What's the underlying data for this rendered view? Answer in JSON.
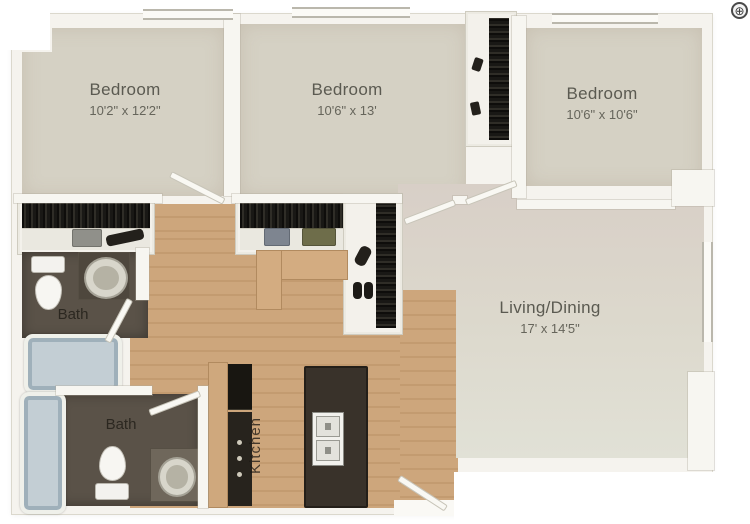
{
  "meta": {
    "title": "3 bedroom / 2 bath apartment floor plan"
  },
  "rooms": {
    "bedroom1": {
      "name": "Bedroom",
      "dimensions": "10'2\" x 12'2\""
    },
    "bedroom2": {
      "name": "Bedroom",
      "dimensions": "10'6\" x 13'"
    },
    "bedroom3": {
      "name": "Bedroom",
      "dimensions": "10'6\" x 10'6\""
    },
    "living_dining": {
      "name": "Living/Dining",
      "dimensions": "17' x 14'5\""
    },
    "bath_upper": {
      "name": "Bath"
    },
    "bath_lower": {
      "name": "Bath"
    },
    "kitchen": {
      "name": "Kitchen"
    }
  },
  "fixtures": {
    "names": [
      "toilet",
      "pedestal-sink",
      "bathtub",
      "hanging-clothes-closet",
      "shoe-closet",
      "refrigerator",
      "stove",
      "kitchen-island",
      "island-sink",
      "entry-door",
      "interior-door",
      "window"
    ]
  },
  "controls": {
    "zoom_icon": "⊕"
  },
  "colors": {
    "bedroom_floor": "#d5d1c4",
    "living_floor": "#dedbd0",
    "wood_floor": "#cda67c",
    "bath_floor": "#5a5248",
    "wall": "#f5f3ee",
    "closet_dark": "#1a1815",
    "tub": "#c3ced4",
    "counter": "#cfa87d",
    "island": "#39322a"
  }
}
